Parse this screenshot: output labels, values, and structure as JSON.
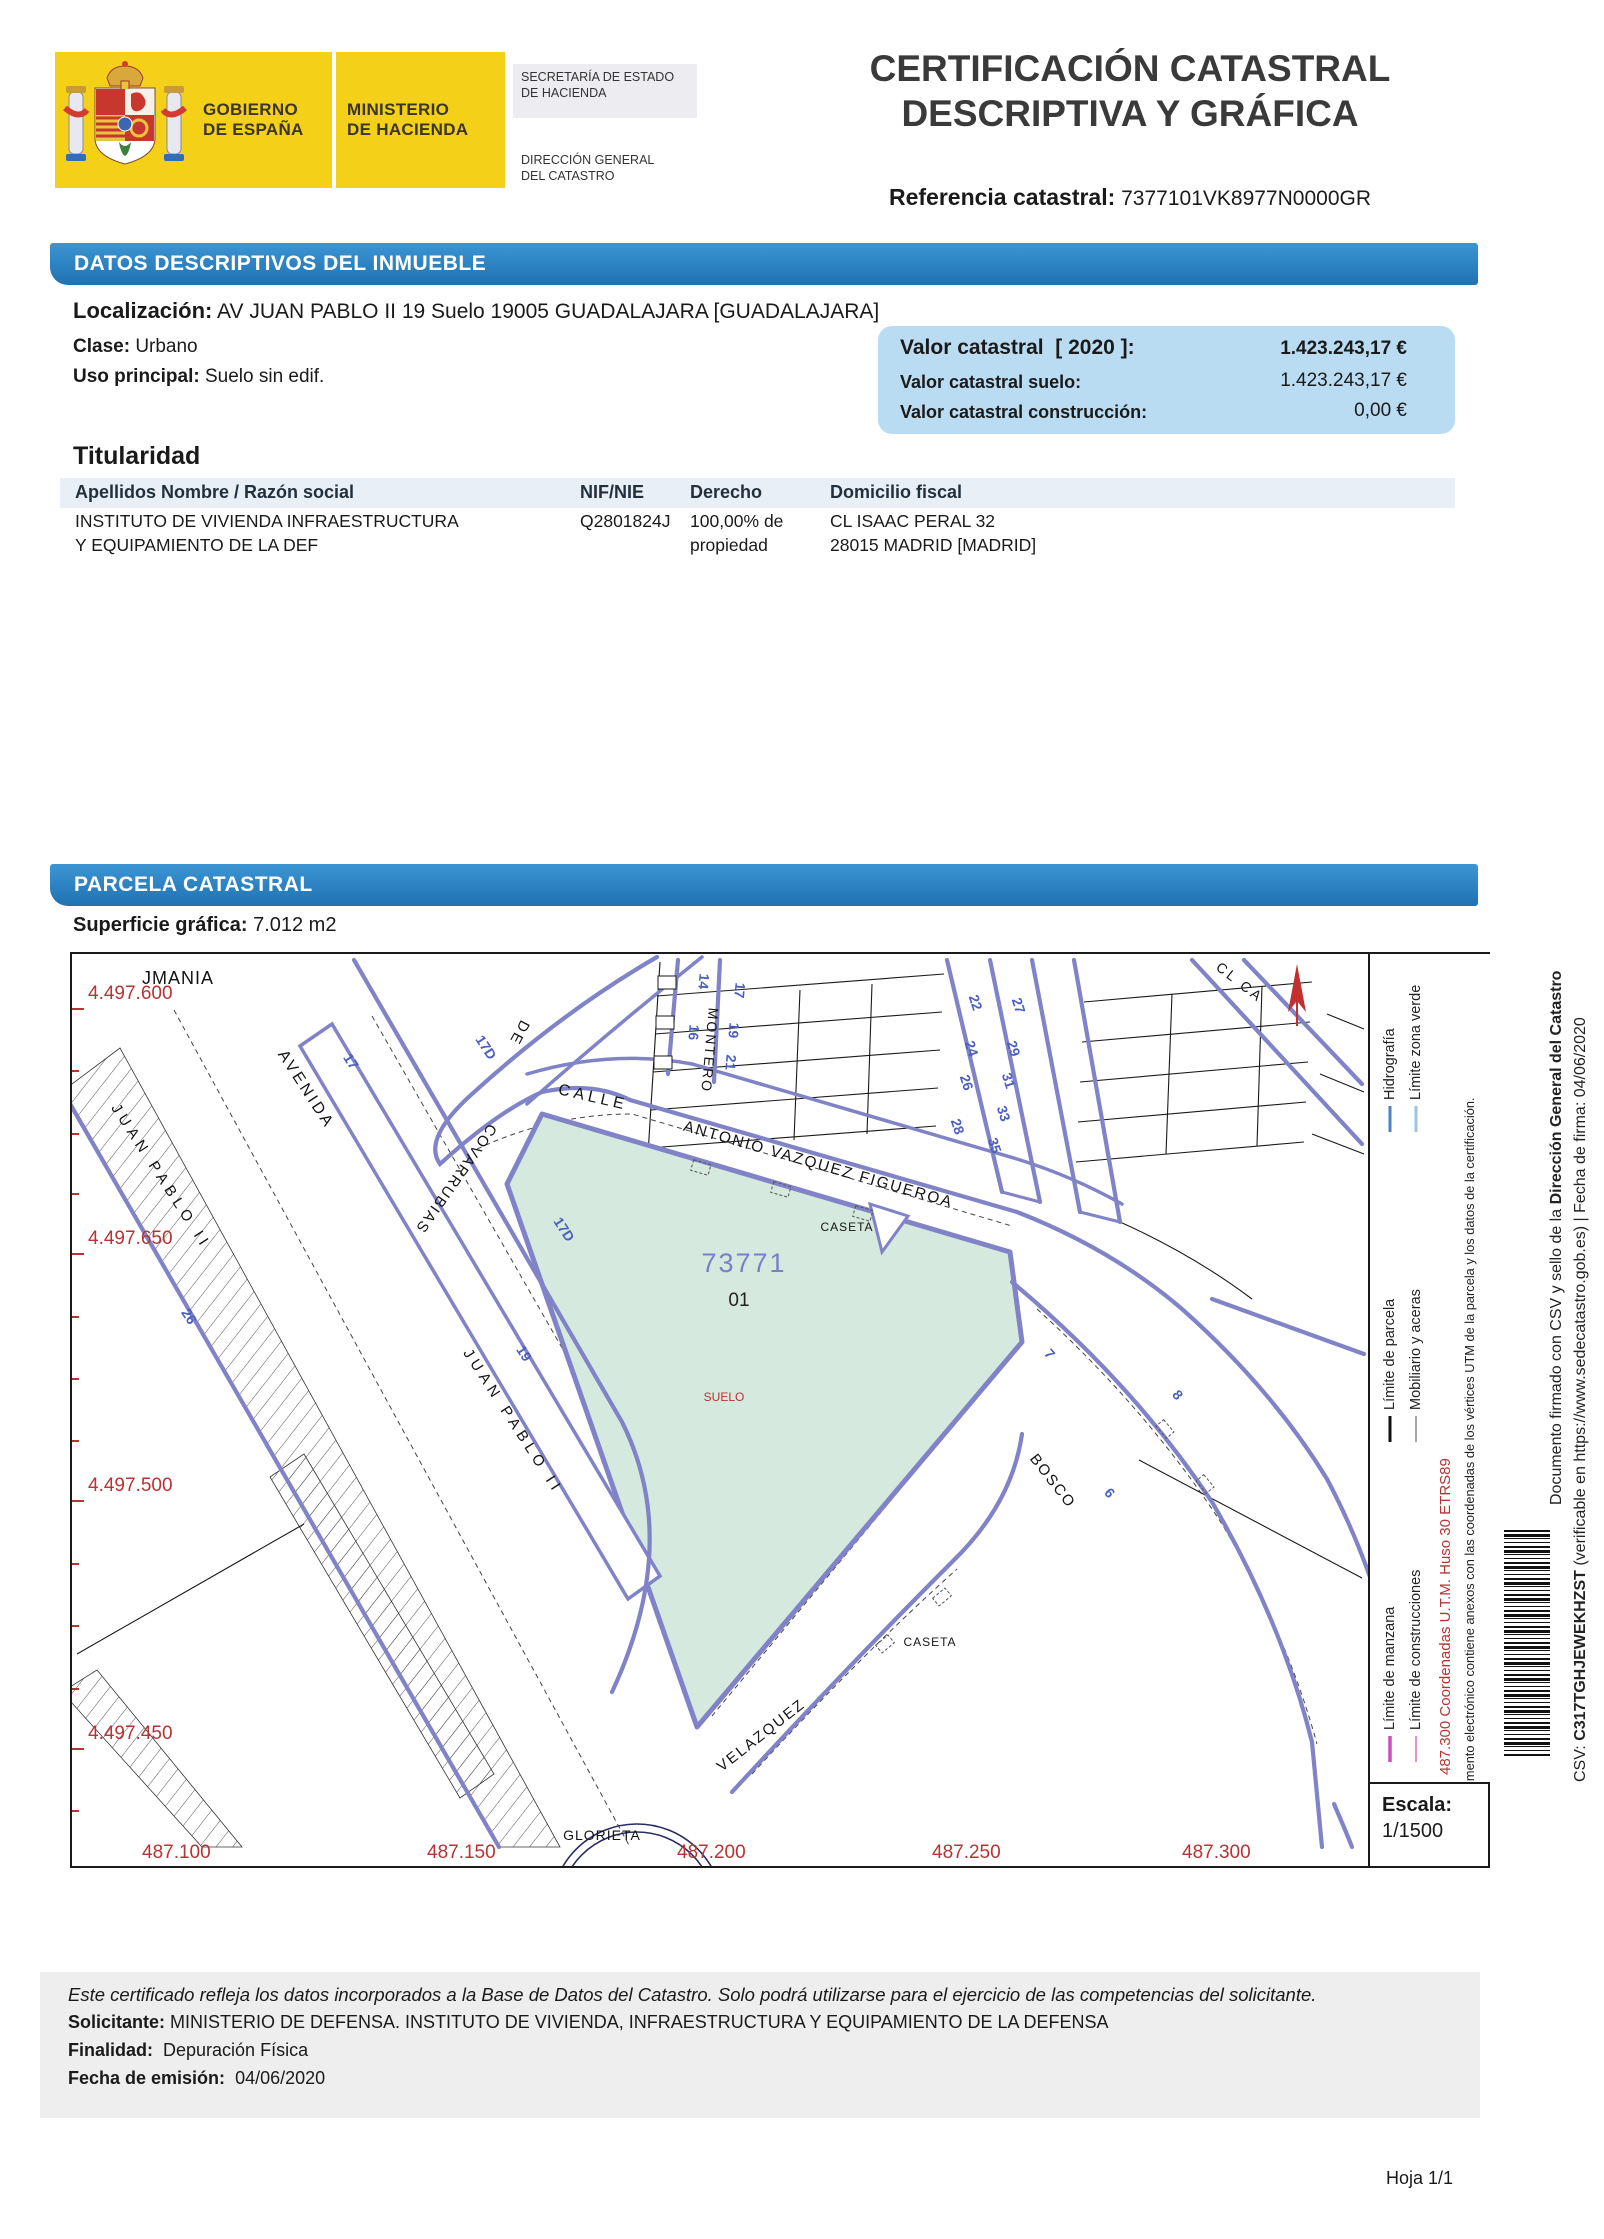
{
  "colors": {
    "banner_blue": "#2B85C4",
    "valor_box": "#BADCF2",
    "street_purple": "#8083C7",
    "parcel_green": "#D6E9DE",
    "coord_red": "#B53434",
    "number_blue": "#4A5FC0",
    "logo_yellow": "#F5D019"
  },
  "header": {
    "gobierno": "GOBIERNO",
    "gobierno2": "DE ESPAÑA",
    "ministerio": "MINISTERIO",
    "ministerio2": "DE HACIENDA",
    "secretaria1": "SECRETARÍA DE ESTADO",
    "secretaria2": "DE HACIENDA",
    "direccion1": "DIRECCIÓN GENERAL",
    "direccion2": "DEL CATASTRO",
    "title1": "CERTIFICACIÓN CATASTRAL",
    "title2": "DESCRIPTIVA Y GRÁFICA",
    "ref_label": "Referencia catastral:",
    "ref_value": "7377101VK8977N0000GR"
  },
  "datos": {
    "banner": "DATOS DESCRIPTIVOS DEL INMUEBLE",
    "localizacion_label": "Localización:",
    "localizacion": "AV JUAN PABLO II 19 Suelo 19005 GUADALAJARA [GUADALAJARA]",
    "clase_label": "Clase:",
    "clase": "Urbano",
    "uso_label": "Uso principal:",
    "uso": "Suelo sin edif.",
    "valor": {
      "l1": "Valor catastral",
      "year": "[ 2020 ]:",
      "v1": "1.423.243,17 €",
      "l2": "Valor catastral suelo:",
      "v2": "1.423.243,17 €",
      "l3": "Valor catastral construcción:",
      "v3": "0,00 €"
    },
    "titularidad": {
      "heading": "Titularidad",
      "columns": [
        "Apellidos Nombre / Razón social",
        "NIF/NIE",
        "Derecho",
        "Domicilio fiscal"
      ],
      "rows": [
        {
          "nombre": [
            "INSTITUTO DE VIVIENDA INFRAESTRUCTURA",
            "Y EQUIPAMIENTO DE LA DEF"
          ],
          "nif": "Q2801824J",
          "derecho": [
            "100,00% de",
            "propiedad"
          ],
          "domicilio": [
            "CL ISAAC PERAL 32",
            "28015 MADRID [MADRID]"
          ]
        }
      ]
    }
  },
  "parcela": {
    "banner": "PARCELA CATASTRAL",
    "superficie_label": "Superficie gráfica:",
    "superficie": "7.012 m2",
    "map": {
      "labels": {
        "jmania": "JMANIA",
        "avenida": "AVENIDA",
        "juan_pablo_1": "JUAN PABLO II",
        "covarrubias": "COVARRUBIAS",
        "de": "DE",
        "calle": "CALLE",
        "antonio": "ANTONIO VAZQUEZ FIGUEROA",
        "montero": "MONTERO",
        "juan_pablo_2": "JUAN PABLO II",
        "velazquez": "VELAZQUEZ",
        "bosco": "BOSCO",
        "glorieta": "GLORIETA",
        "caseta_1": "CASETA",
        "caseta_2": "CASETA",
        "cl_ca": "CL CA",
        "parcel_number": "73771",
        "subparcel": "01",
        "suelo": "SUELO"
      },
      "numbers": {
        "n17d_a": "17D",
        "n17": "17",
        "n17d_b": "17D",
        "n26": "26",
        "n19": "19",
        "m14": "14",
        "m16": "16",
        "m17": "17",
        "m19": "19",
        "m21": "21",
        "e22": "22",
        "e24": "24",
        "e26": "26",
        "e28": "28",
        "o27": "27",
        "o29": "29",
        "o31": "31",
        "o33": "33",
        "o35": "35",
        "b7": "7",
        "b8": "8",
        "b6": "6"
      },
      "coords": {
        "left": [
          "4.497.600",
          "4.497.650",
          "4.497.500",
          "4.497.450"
        ],
        "bottom": [
          "487.100",
          "487.150",
          "487.200",
          "487.250",
          "487.300"
        ]
      }
    },
    "legend": {
      "items": [
        {
          "label": "Límite de manzana",
          "color": "#C94FC9"
        },
        {
          "label": "Límite de parcela",
          "color": "#111111"
        },
        {
          "label": "Hidrografía",
          "color": "#4F81C7"
        },
        {
          "label": "Límite de construcciones",
          "color": "#E394D4"
        },
        {
          "label": "Mobiliario y aceras",
          "color": "#A6A6A6"
        },
        {
          "label": "Límite zona verde",
          "color": "#9DC3E6"
        }
      ],
      "utm_note": "487.300 Coordenadas U.T.M. Huso 30 ETRS89",
      "anexos_note": "Este documento electrónico contiene anexos con las coordenadas de los vértices UTM de la parcela y los datos de la certificación.",
      "escala_label": "Escala:",
      "escala_value": "1/1500"
    }
  },
  "sidebar": {
    "l1a": "Documento firmado con CSV y sello de la ",
    "l1b": "Dirección General del Catastro",
    "csv_label": "CSV: ",
    "csv_value": "C317TGHJEWEKHZST",
    "csv_rest": "  (verificable en https://www.sedecatastro.gob.es)   |   Fecha de firma: 04/06/2020"
  },
  "footer": {
    "disclaimer": "Este certificado refleja los datos incorporados a la Base de Datos del Catastro. Solo podrá utilizarse para el ejercicio de las competencias del solicitante.",
    "solicitante_label": "Solicitante:",
    "solicitante": "MINISTERIO DE DEFENSA. INSTITUTO DE VIVIENDA, INFRAESTRUCTURA Y EQUIPAMIENTO DE LA DEFENSA",
    "finalidad_label": "Finalidad:",
    "finalidad": "Depuración Física",
    "fecha_label": "Fecha de emisión:",
    "fecha": "04/06/2020",
    "hoja": "Hoja 1/1"
  }
}
